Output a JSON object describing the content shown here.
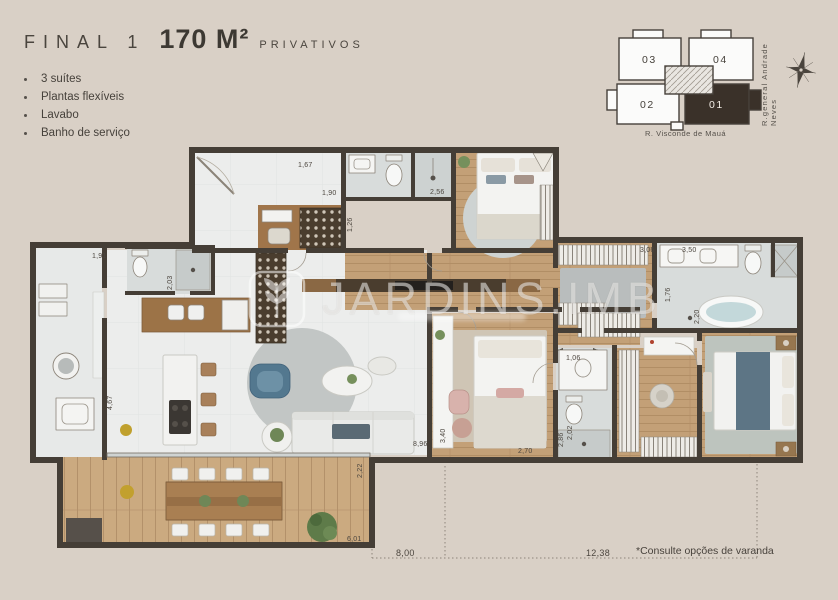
{
  "header": {
    "final_label": "FINAL 1",
    "area_value": "170 M²",
    "area_suffix": "PRIVATIVOS"
  },
  "features": [
    "3 suítes",
    "Plantas flexíveis",
    "Lavabo",
    "Banho de serviço"
  ],
  "keyplan": {
    "units": [
      "03",
      "04",
      "02",
      "01"
    ],
    "highlighted_unit": "01",
    "street_bottom": "R. Visconde de Mauá",
    "street_right": "R.general Andrade Neves"
  },
  "watermark": {
    "brand": "JARDINS.IMB"
  },
  "plan": {
    "dims": [
      "1,67",
      "1,90",
      "1,26",
      "2,56",
      "1,91",
      "2,03",
      "4,67",
      "2,22",
      "6,01",
      "8,96",
      "3,40",
      "2,70",
      "2,86",
      "1,06",
      "3,06",
      "3,50",
      "1,76",
      "2,20",
      "2,02"
    ],
    "outer_width_left": "8,00",
    "outer_width_right": "12,38"
  },
  "footnote": "*Consulte opções de varanda",
  "colors": {
    "background": "#d9d0c6",
    "wall": "#453e36",
    "wood_floor": "#c3a077",
    "tile_floor": "#ecedec",
    "highlight_unit_fill": "#3a3129",
    "accent_blue": "#53788f",
    "text": "#46413b"
  }
}
